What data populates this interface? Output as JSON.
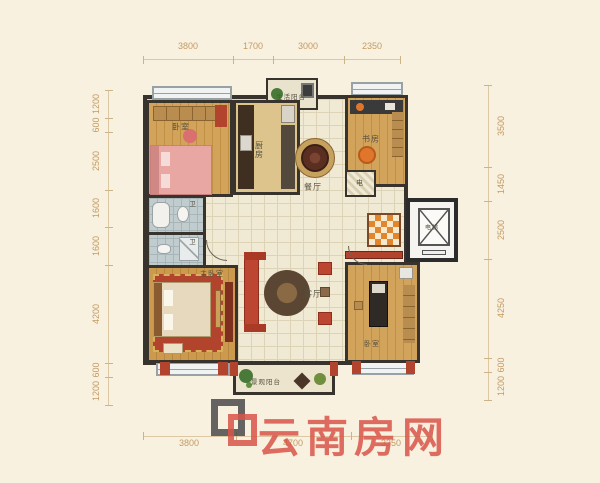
{
  "watermark": {
    "site_name": "云南房网"
  },
  "dimensions": {
    "unit": "mm",
    "top": [
      "3800",
      "1700",
      "3000",
      "2350"
    ],
    "left": [
      "1200",
      "600",
      "2500",
      "1600",
      "1600",
      "4200",
      "600",
      "1200"
    ],
    "right": [
      "3500",
      "1450",
      "2500",
      "4250",
      "600",
      "1200"
    ],
    "bottom": [
      "3800",
      "4700",
      "3350"
    ]
  },
  "rooms": {
    "bedroom_top_left": "卧室",
    "kitchen": "厨房",
    "service_balcony": "生活阳台",
    "dining": "餐厅",
    "study": "书房",
    "utility_shaft": "电",
    "elevator": "电梯",
    "bath_upper": "卫",
    "bath_lower": "卫",
    "master_bedroom": "主卧室",
    "living_room": "客厅",
    "bedroom_bottom_right": "卧室",
    "view_balcony": "景观阳台"
  },
  "colors": {
    "background": "#f8f1e0",
    "dimension_text": "#c49a62",
    "wall": "#38332c",
    "accent_red_wall": "#b2432c",
    "watermark_red": "#d85348",
    "wood_floor": "#c99245",
    "checker_orange": "#e2862e"
  }
}
